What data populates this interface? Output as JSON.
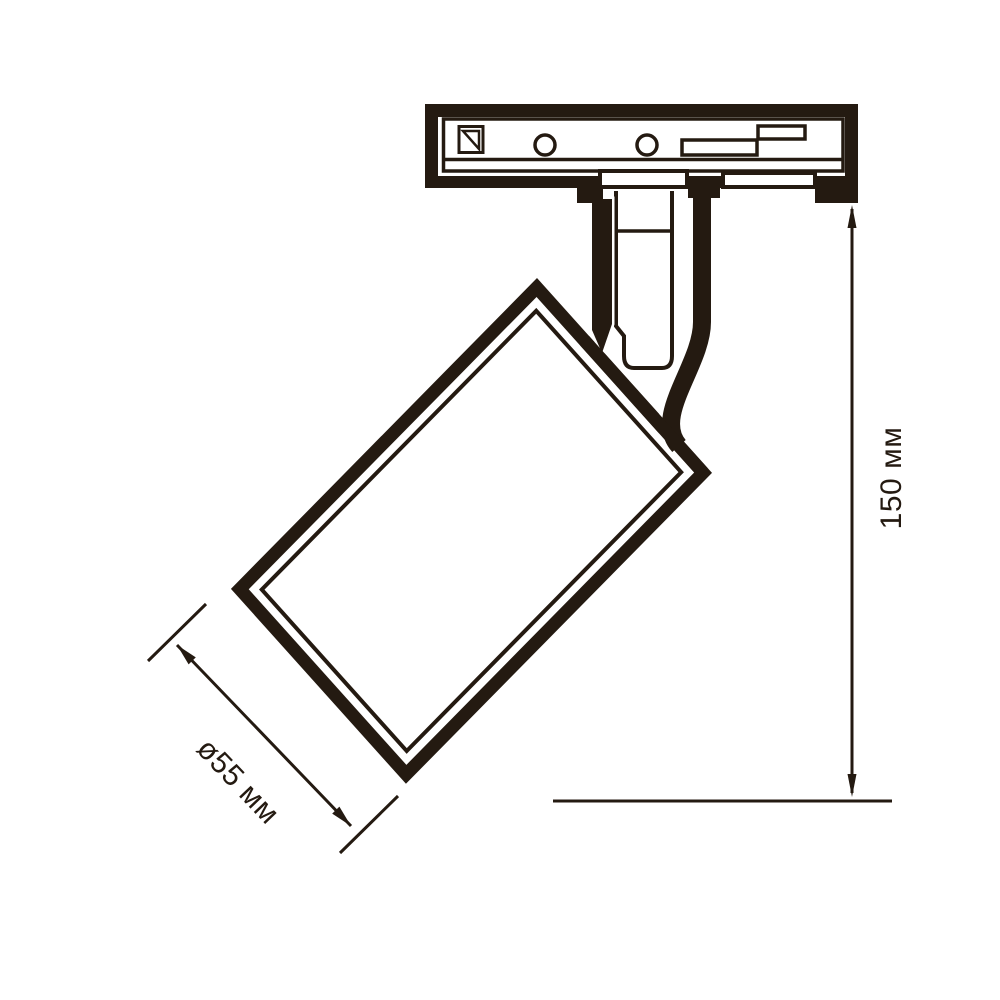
{
  "drawing": {
    "ink_color": "#241a11",
    "background_color": "#ffffff",
    "dimensions": {
      "diameter": {
        "label": "ø55 мм"
      },
      "height": {
        "label": "150 мм"
      }
    }
  }
}
